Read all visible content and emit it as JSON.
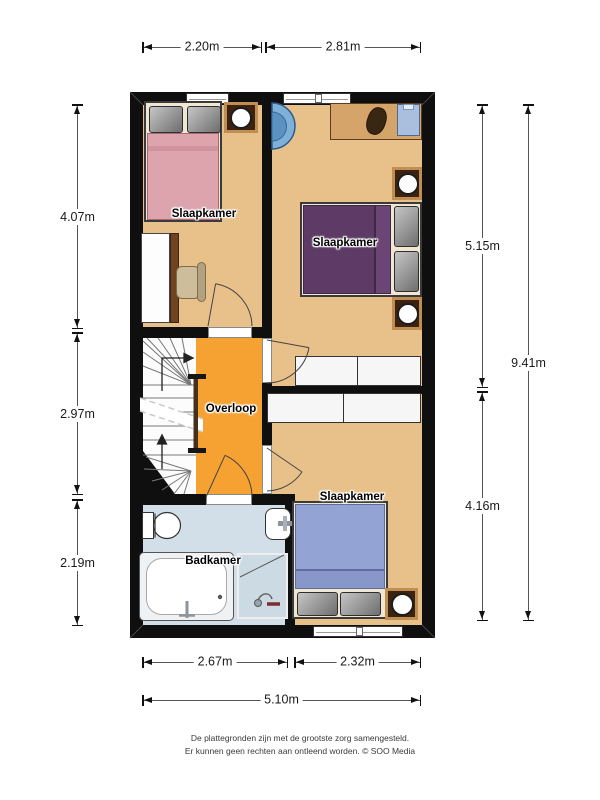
{
  "plan": {
    "rooms": [
      {
        "id": "bedroom-top-left",
        "label": "Slaapkamer"
      },
      {
        "id": "bedroom-top-right",
        "label": "Slaapkamer"
      },
      {
        "id": "landing",
        "label": "Overloop"
      },
      {
        "id": "bathroom",
        "label": "Badkamer"
      },
      {
        "id": "bedroom-bottom",
        "label": "Slaapkamer"
      }
    ],
    "furniture": {
      "bedroom_top_left": [
        "double-bed",
        "side-table-lamp",
        "desk",
        "chair"
      ],
      "bedroom_top_right": [
        "corner-basin",
        "dresser-with-clothes",
        "double-bed",
        "side-table-lamp",
        "side-table-lamp",
        "wardrobe"
      ],
      "landing": [
        "winder-staircase",
        "up-arrows",
        "stair-break-line"
      ],
      "bathroom": [
        "toilet",
        "washbasin",
        "bathtub",
        "shower"
      ],
      "bedroom_bottom": [
        "double-bed",
        "side-table-lamp",
        "wardrobe"
      ]
    }
  },
  "dimensions": {
    "top": [
      {
        "value": "2.20m"
      },
      {
        "value": "2.81m"
      }
    ],
    "left": [
      {
        "value": "4.07m"
      },
      {
        "value": "2.97m"
      },
      {
        "value": "2.19m"
      }
    ],
    "right": [
      {
        "value": "5.15m"
      },
      {
        "value": "4.16m"
      },
      {
        "value": "9.41m"
      }
    ],
    "bottom": [
      {
        "value": "2.67m"
      },
      {
        "value": "2.32m"
      },
      {
        "value": "5.10m"
      }
    ]
  },
  "footer": {
    "line1": "De plattegronden zijn met de grootste zorg samengesteld.",
    "line2": "Er kunnen geen rechten aan ontleend worden. © SOO Media"
  },
  "colors": {
    "wall": "#0f0f0f",
    "floor_bedroom": "#e8c08a",
    "floor_landing": "#f5a232",
    "floor_bathroom": "#d2dfe8",
    "bed_pink": "#dea4ae",
    "bed_purple": "#5e3a66",
    "bed_blue": "#93a3d3",
    "wood": "#d5a46b",
    "basin_blue": "#7fb0d8"
  }
}
